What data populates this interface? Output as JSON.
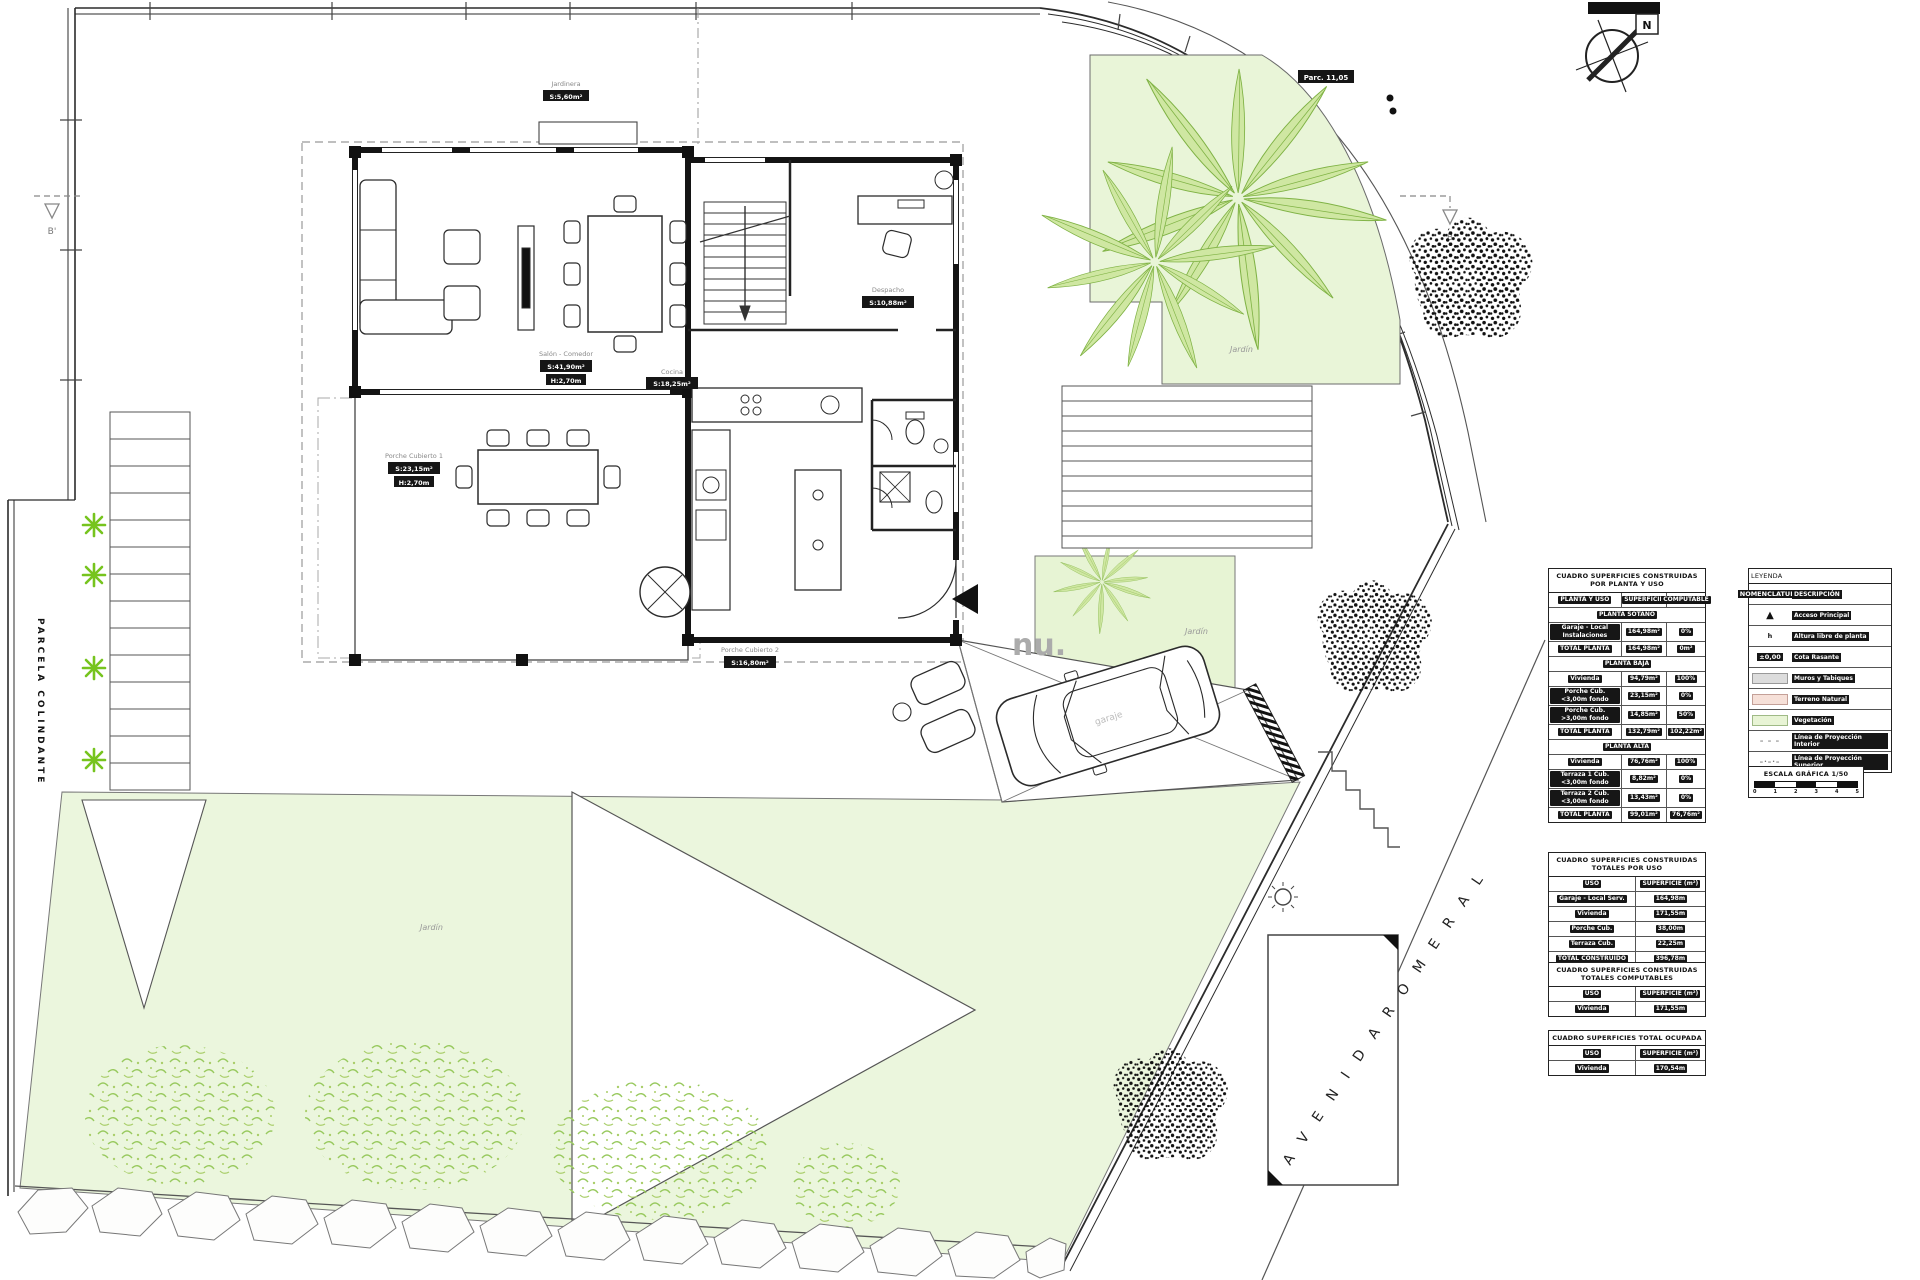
{
  "plan": {
    "watermark": "nu.",
    "street_name": "A V E N I D A   R O M E R A L",
    "left_wall_label": "PARCELA COLINDANTE",
    "north_label": "N",
    "section_marker_left": "B'",
    "section_marker_right": "B",
    "curb_label": "Parc. 11,05",
    "garden_label_top": "Jardín",
    "garden_label_mid": "Jardín",
    "garden_label_lawn": "Jardín",
    "car_label": "garaje",
    "rooms": {
      "salon": {
        "title": "Salón - Comedor",
        "area": "S:41,90m²",
        "height": "H:2,70m"
      },
      "porche1": {
        "title": "Porche Cubierto 1",
        "area": "S:23,15m²",
        "height": "H:2,70m"
      },
      "porche2": {
        "title": "Porche Cubierto 2",
        "area": "S:16,80m²"
      },
      "despacho": {
        "title": "Despacho",
        "area": "S:10,88m²"
      },
      "cocina": {
        "title": "Cocina",
        "area": "S:18,25m²"
      },
      "jardinera": {
        "title": "Jardinera",
        "area": "S:5,60m²"
      }
    }
  },
  "tables": {
    "by_floor": {
      "title": "CUADRO SUPERFICIES CONSTRUIDAS POR PLANTA Y USO",
      "rows": [
        {
          "cls": "head",
          "c0": "PLANTA Y USO",
          "c1": "SUPERFICIE",
          "c2": "COMPUTABLE"
        },
        {
          "cls": "sec",
          "c0": "PLANTA SÓTANO",
          "c1": "",
          "c2": ""
        },
        {
          "cls": "",
          "c0": "Garaje - Local Instalaciones",
          "c1": "164,98m²",
          "c2": "0%"
        },
        {
          "cls": "tot",
          "c0": "TOTAL PLANTA",
          "c1": "164,98m²",
          "c2": "0m²"
        },
        {
          "cls": "sec",
          "c0": "PLANTA BAJA",
          "c1": "",
          "c2": ""
        },
        {
          "cls": "",
          "c0": "Vivienda",
          "c1": "94,79m²",
          "c2": "100%"
        },
        {
          "cls": "",
          "c0": "Porche Cub. <3,00m fondo",
          "c1": "23,15m²",
          "c2": "0%"
        },
        {
          "cls": "",
          "c0": "Porche Cub. >3,00m fondo",
          "c1": "14,85m²",
          "c2": "50%"
        },
        {
          "cls": "tot",
          "c0": "TOTAL PLANTA",
          "c1": "132,79m²",
          "c2": "102,22m²"
        },
        {
          "cls": "sec",
          "c0": "PLANTA ALTA",
          "c1": "",
          "c2": ""
        },
        {
          "cls": "",
          "c0": "Vivienda",
          "c1": "76,76m²",
          "c2": "100%"
        },
        {
          "cls": "",
          "c0": "Terraza 1 Cub. <3,00m fondo",
          "c1": "8,82m²",
          "c2": "0%"
        },
        {
          "cls": "",
          "c0": "Terraza 2 Cub. <3,00m fondo",
          "c1": "13,43m²",
          "c2": "0%"
        },
        {
          "cls": "tot",
          "c0": "TOTAL PLANTA",
          "c1": "99,01m²",
          "c2": "76,76m²"
        }
      ]
    },
    "totals_by_use": {
      "title": "CUADRO SUPERFICIES CONSTRUIDAS TOTALES POR USO",
      "rows": [
        {
          "cls": "head",
          "c0": "USO",
          "c1": "SUPERFICIE (m²)"
        },
        {
          "cls": "",
          "c0": "Garaje - Local Serv.",
          "c1": "164,98m"
        },
        {
          "cls": "",
          "c0": "Vivienda",
          "c1": "171,55m"
        },
        {
          "cls": "",
          "c0": "Porche Cub.",
          "c1": "38,00m"
        },
        {
          "cls": "",
          "c0": "Terraza Cub.",
          "c1": "22,25m"
        },
        {
          "cls": "tot",
          "c0": "TOTAL CONSTRUIDO",
          "c1": "396,78m"
        }
      ]
    },
    "computables": {
      "title": "CUADRO SUPERFICIES CONSTRUIDAS TOTALES COMPUTABLES",
      "rows": [
        {
          "cls": "head",
          "c0": "USO",
          "c1": "SUPERFICIE (m²)"
        },
        {
          "cls": "",
          "c0": "Vivienda",
          "c1": "171,55m"
        }
      ]
    },
    "ocupada": {
      "title": "CUADRO SUPERFICIES TOTAL OCUPADA",
      "rows": [
        {
          "cls": "head",
          "c0": "USO",
          "c1": "SUPERFICIE (m²)"
        },
        {
          "cls": "",
          "c0": "Vivienda",
          "c1": "170,54m"
        }
      ]
    }
  },
  "legend": {
    "title": "LEYENDA",
    "rows": [
      {
        "cls": "head",
        "sym": "NOMENCLATURA",
        "label": "DESCRIPCIÓN"
      },
      {
        "cls": "tri",
        "sym": "▲",
        "label": "Acceso Principal"
      },
      {
        "cls": "hsym",
        "sym": "h",
        "label": "Altura libre de planta"
      },
      {
        "cls": "cota",
        "sym": "±0,00",
        "label": "Cota Rasante"
      },
      {
        "cls": "wall",
        "sym": "",
        "label": "Muros y Tabiques"
      },
      {
        "cls": "terr",
        "sym": "",
        "label": "Terreno Natural"
      },
      {
        "cls": "veg",
        "sym": "",
        "label": "Vegetación"
      },
      {
        "cls": "dash",
        "sym": "– – –",
        "label": "Línea de Proyección Interior"
      },
      {
        "cls": "dashdot",
        "sym": "–·–·–",
        "label": "Línea de Proyección Superior"
      }
    ],
    "scale_title": "ESCALA GRÁFICA 1/50",
    "scale_ticks": [
      "0",
      "1",
      "2",
      "3",
      "4",
      "5"
    ]
  },
  "colors": {
    "lawn": "#ebf6dd",
    "garden": "#e7f4d4",
    "palm_leaf": "#cfe7a2",
    "palm_stroke": "#7fb244",
    "star_plant": "#76c41e",
    "line": "#2b2b2b",
    "projection": "#999999",
    "watermark_gray": "#ababab"
  }
}
